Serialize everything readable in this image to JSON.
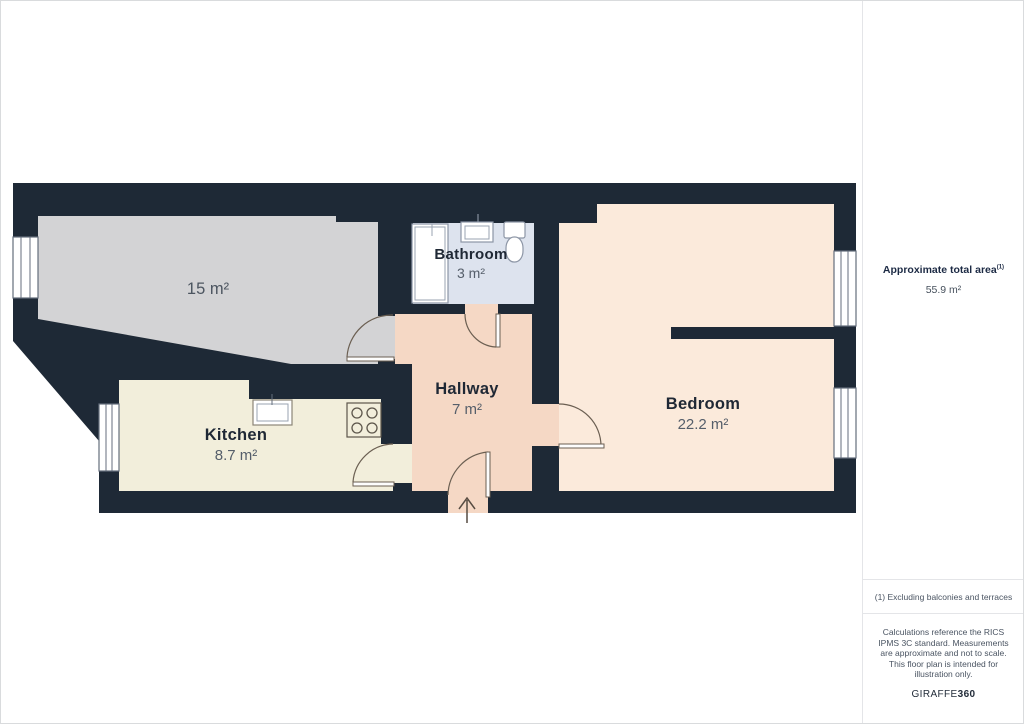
{
  "plan": {
    "colors": {
      "wall": "#1e2936",
      "living": "#d3d3d5",
      "kitchen": "#f2eedb",
      "bathroom": "#dde3ee",
      "hallway": "#f5d8c5",
      "bedroom": "#fbeadb"
    },
    "rooms": {
      "living": {
        "area": "15 m²"
      },
      "kitchen": {
        "name": "Kitchen",
        "area": "8.7 m²"
      },
      "bathroom": {
        "name": "Bathroom",
        "area": "3 m²"
      },
      "hallway": {
        "name": "Hallway",
        "area": "7 m²"
      },
      "bedroom": {
        "name": "Bedroom",
        "area": "22.2 m²"
      }
    }
  },
  "sidebar": {
    "total_area_label": "Approximate total area",
    "total_area_note_ref": "(1)",
    "total_area_value": "55.9 m²",
    "footnote": "(1) Excluding balconies and terraces",
    "disclaimer": "Calculations reference the RICS IPMS 3C standard. Measurements are approximate and not to scale. This floor plan is intended for illustration only.",
    "brand_name": "GIRAFFE",
    "brand_suffix": "360"
  }
}
